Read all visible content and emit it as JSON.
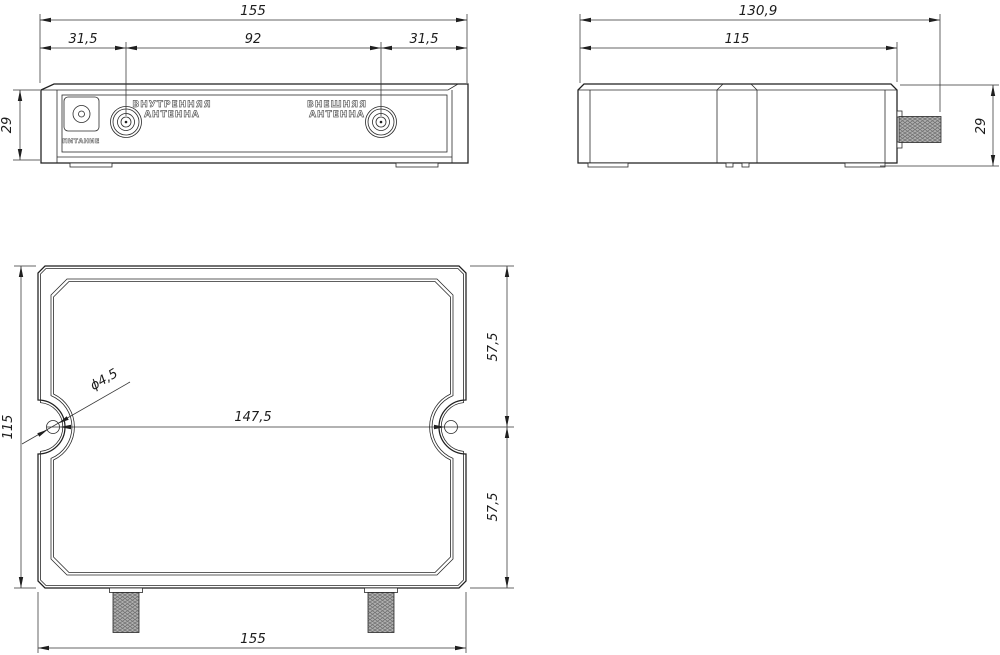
{
  "views": {
    "front": {
      "dim_overall_width": "155",
      "dim_left_offset": "31,5",
      "dim_connector_spacing": "92",
      "dim_right_offset": "31,5",
      "dim_height": "29",
      "label_power": "ПИТАНИЕ",
      "label_internal_antenna_l1": "ВНУТРЕННЯЯ",
      "label_internal_antenna_l2": "АНТЕННА",
      "label_external_antenna_l1": "ВНЕШНЯЯ",
      "label_external_antenna_l2": "АНТЕННА"
    },
    "side": {
      "dim_overall_depth": "130,9",
      "dim_body_depth": "115",
      "dim_height": "29"
    },
    "bottom": {
      "dim_height": "115",
      "dim_top_half": "57,5",
      "dim_bottom_half": "57,5",
      "dim_hole_spacing": "147,5",
      "dim_hole_diameter": "ϕ4,5",
      "dim_overall_width": "155"
    }
  }
}
